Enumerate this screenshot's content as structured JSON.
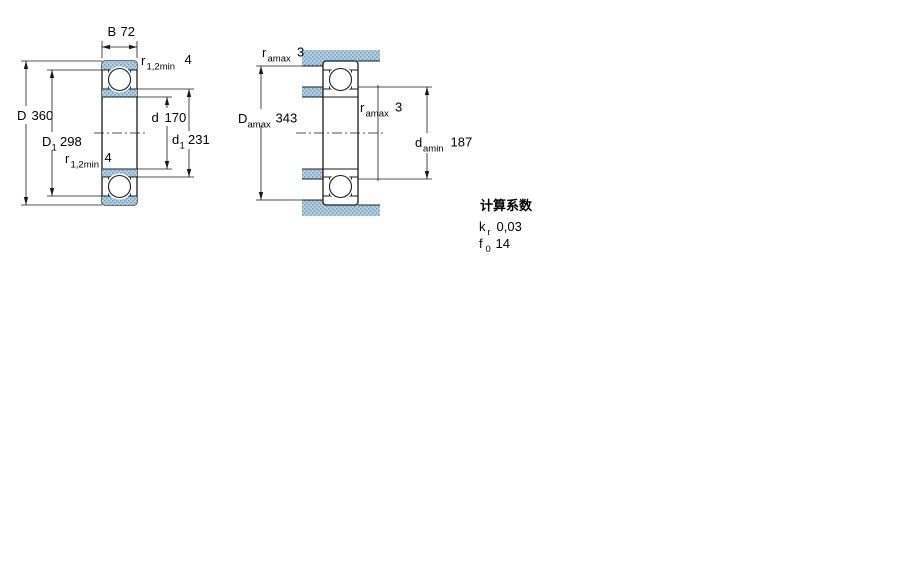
{
  "colors": {
    "line": "#1a1a1a",
    "text": "#000000",
    "hatch_fill": "#b3cfdf",
    "hatch_dot": "#6d9cc0",
    "background": "#ffffff"
  },
  "front_view": {
    "width_dim": {
      "symbol": "B",
      "value": "72"
    },
    "outer_diameter": {
      "symbol": "D",
      "value": "360"
    },
    "outer_shoulder_diameter": {
      "symbol": "D",
      "sub": "1",
      "value": "298"
    },
    "bore_diameter": {
      "symbol": "d",
      "value": "170"
    },
    "inner_shoulder_diameter": {
      "symbol": "d",
      "sub": "1",
      "value": "231"
    },
    "fillet_radius_top": {
      "symbol": "r",
      "sub": "1,2min",
      "value": "4"
    },
    "fillet_radius_bottom": {
      "symbol": "r",
      "sub": "1,2min",
      "value": "4"
    }
  },
  "mounted_view": {
    "housing_fillet_radius": {
      "symbol": "r",
      "sub": "amax",
      "value": "3"
    },
    "shaft_fillet_radius": {
      "symbol": "r",
      "sub": "amax",
      "value": "3"
    },
    "housing_abutment_diameter": {
      "symbol": "D",
      "sub": "amax",
      "value": "343"
    },
    "shaft_abutment_diameter": {
      "symbol": "d",
      "sub": "amin",
      "value": "187"
    }
  },
  "calculation_factors": {
    "heading": "计算系数",
    "factor_kr": {
      "symbol": "k",
      "sub": "r",
      "value": "0,03"
    },
    "factor_f0": {
      "symbol": "f",
      "sub": "0",
      "value": "14"
    }
  }
}
